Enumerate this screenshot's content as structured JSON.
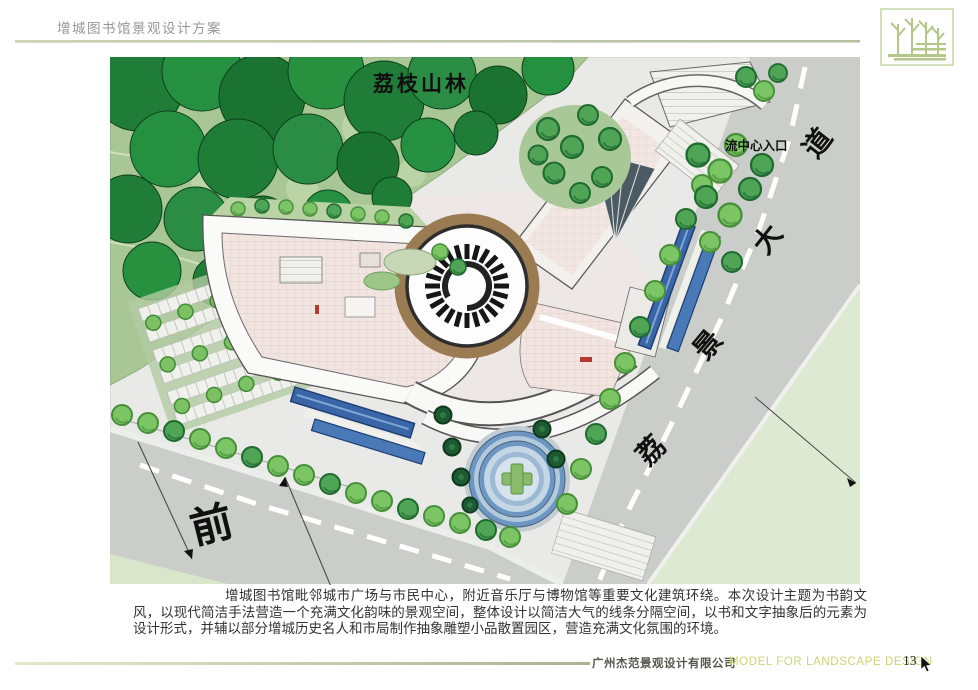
{
  "header": {
    "title": "增城图书馆景观设计方案"
  },
  "logo": {
    "symbol": "trees-logo"
  },
  "plan": {
    "labels": {
      "forest": "荔枝山林",
      "entrance": "流中心入口",
      "road_chars": [
        "道",
        "大",
        "景",
        "荔"
      ],
      "front": "前"
    }
  },
  "description": {
    "text": "增城图书馆毗邻城市广场与市民中心，附近音乐厅与博物馆等重要文化建筑环绕。本次设计主题为书韵文风，以现代简洁手法营造一个充满文化韵味的景观空间，整体设计以简洁大气的线条分隔空间，以书和文字抽象后的元素为设计形式，并辅以部分增城历史名人和市局制作抽象雕塑小品散置园区，营造充满文化氛围的环境。"
  },
  "footer": {
    "company": "广州杰范景观设计有限公司",
    "tagline": "MODEL FOR LANDSCAPE DESIGN",
    "page_number": "13"
  },
  "colors": {
    "accent_green": "#c9d6ae",
    "forest_dark": "#1f7d37",
    "forest_bg": "#a8c795",
    "road_grey": "#cbcdca",
    "water_blue": "#3a66a8",
    "tile_pink": "#f2e5e1",
    "tagline_green": "#c9d574"
  }
}
